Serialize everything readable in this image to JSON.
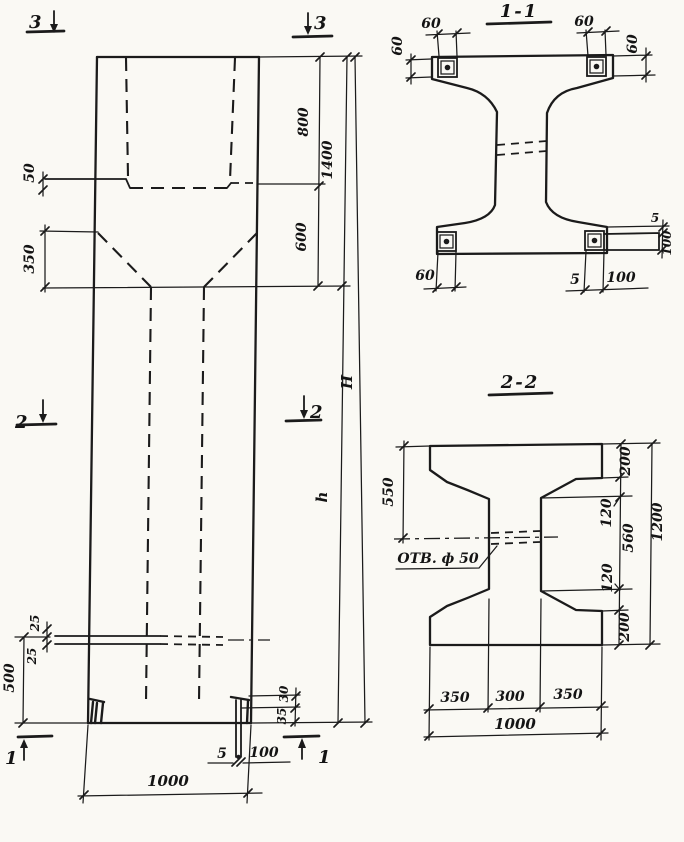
{
  "colors": {
    "paper": "#faf9f4",
    "ink": "#1b1b1b"
  },
  "elevation": {
    "markers": {
      "top_left": "3",
      "top_right": "3",
      "mid_left": "2",
      "mid_right": "2",
      "bottom_left": "1",
      "bottom_right": "1"
    },
    "dims": {
      "embed_plate_thickness": "50",
      "taper_height": "350",
      "head_upper": "800",
      "head_lower": "600",
      "head_total": "1400",
      "overall_height": "H",
      "shaft_height": "h",
      "rod_offset_upper": "25",
      "rod_offset_lower": "25",
      "rod_level_height": "500",
      "shoe_upper": "30",
      "shoe_lower": "35",
      "base_plate_thickness": "5",
      "base_plate_length": "100",
      "column_width": "1000"
    }
  },
  "section_1_1": {
    "title": "1-1",
    "dims": {
      "plate_tl_width": "60",
      "plate_tl_height": "60",
      "plate_tr_width": "60",
      "plate_tr_height": "60",
      "plate_bl_width": "60",
      "side_plate_gap": "5",
      "side_plate_height": "100",
      "bottom_plate_thickness": "5",
      "bottom_plate_length": "100"
    }
  },
  "section_2_2": {
    "title": "2-2",
    "hole_label": "ОТВ. ф 50",
    "dims": {
      "top_to_hole": "550",
      "flange_top": "200",
      "chamfer_top": "120",
      "web_height": "560",
      "chamfer_bottom": "120",
      "flange_bottom": "200",
      "overall": "1200",
      "bottom_left": "350",
      "bottom_mid": "300",
      "bottom_right": "350",
      "bottom_total": "1000"
    }
  }
}
